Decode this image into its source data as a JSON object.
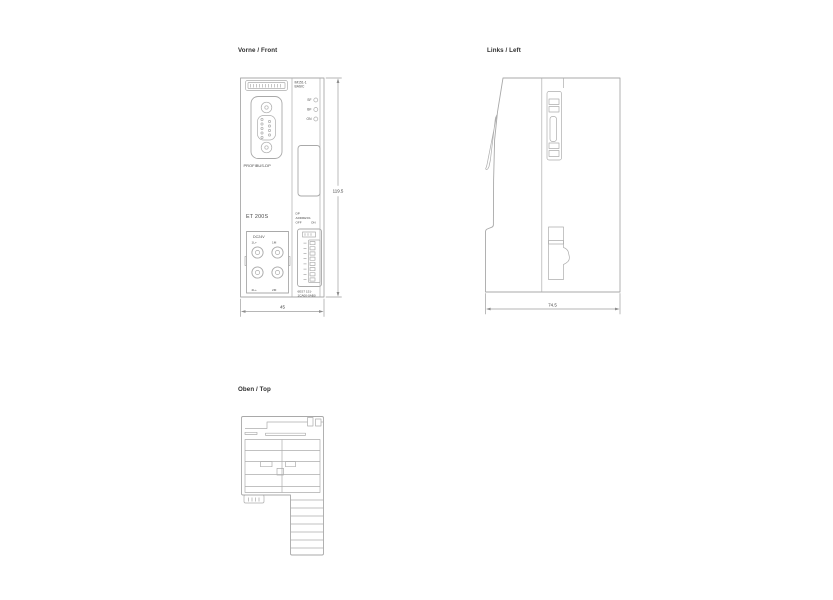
{
  "colors": {
    "background": "#ffffff",
    "drawing_line": "#a9a9a9",
    "dimension_line": "#9e9e9e",
    "title_text": "#2f2f2f",
    "label_text": "#4a4a4a"
  },
  "views": {
    "front": {
      "title": "Vorne / Front",
      "labels": {
        "profibus": "PROFIBUS-DP",
        "product": "ET 200S",
        "power": "DC24V",
        "terminal_1l": "1L+",
        "terminal_1m": "1M",
        "terminal_2l": "2L+",
        "terminal_2m": "2M",
        "module_line1": "IM151-1",
        "module_line2": "BASIC",
        "led_sf": "SF",
        "led_bf": "BF",
        "led_on": "ON",
        "dip_line1": "DP",
        "dip_line2": "ADDRESS",
        "dip_off": "OFF",
        "dip_on": "ON",
        "order_line1": "6ES7 151-",
        "order_line2": "1CA00-0AB0"
      },
      "dimensions": {
        "height_mm": "119.5",
        "width_mm": "45"
      }
    },
    "left": {
      "title": "Links / Left",
      "dimensions": {
        "depth_mm": "74.5"
      }
    },
    "top": {
      "title": "Oben / Top"
    }
  }
}
